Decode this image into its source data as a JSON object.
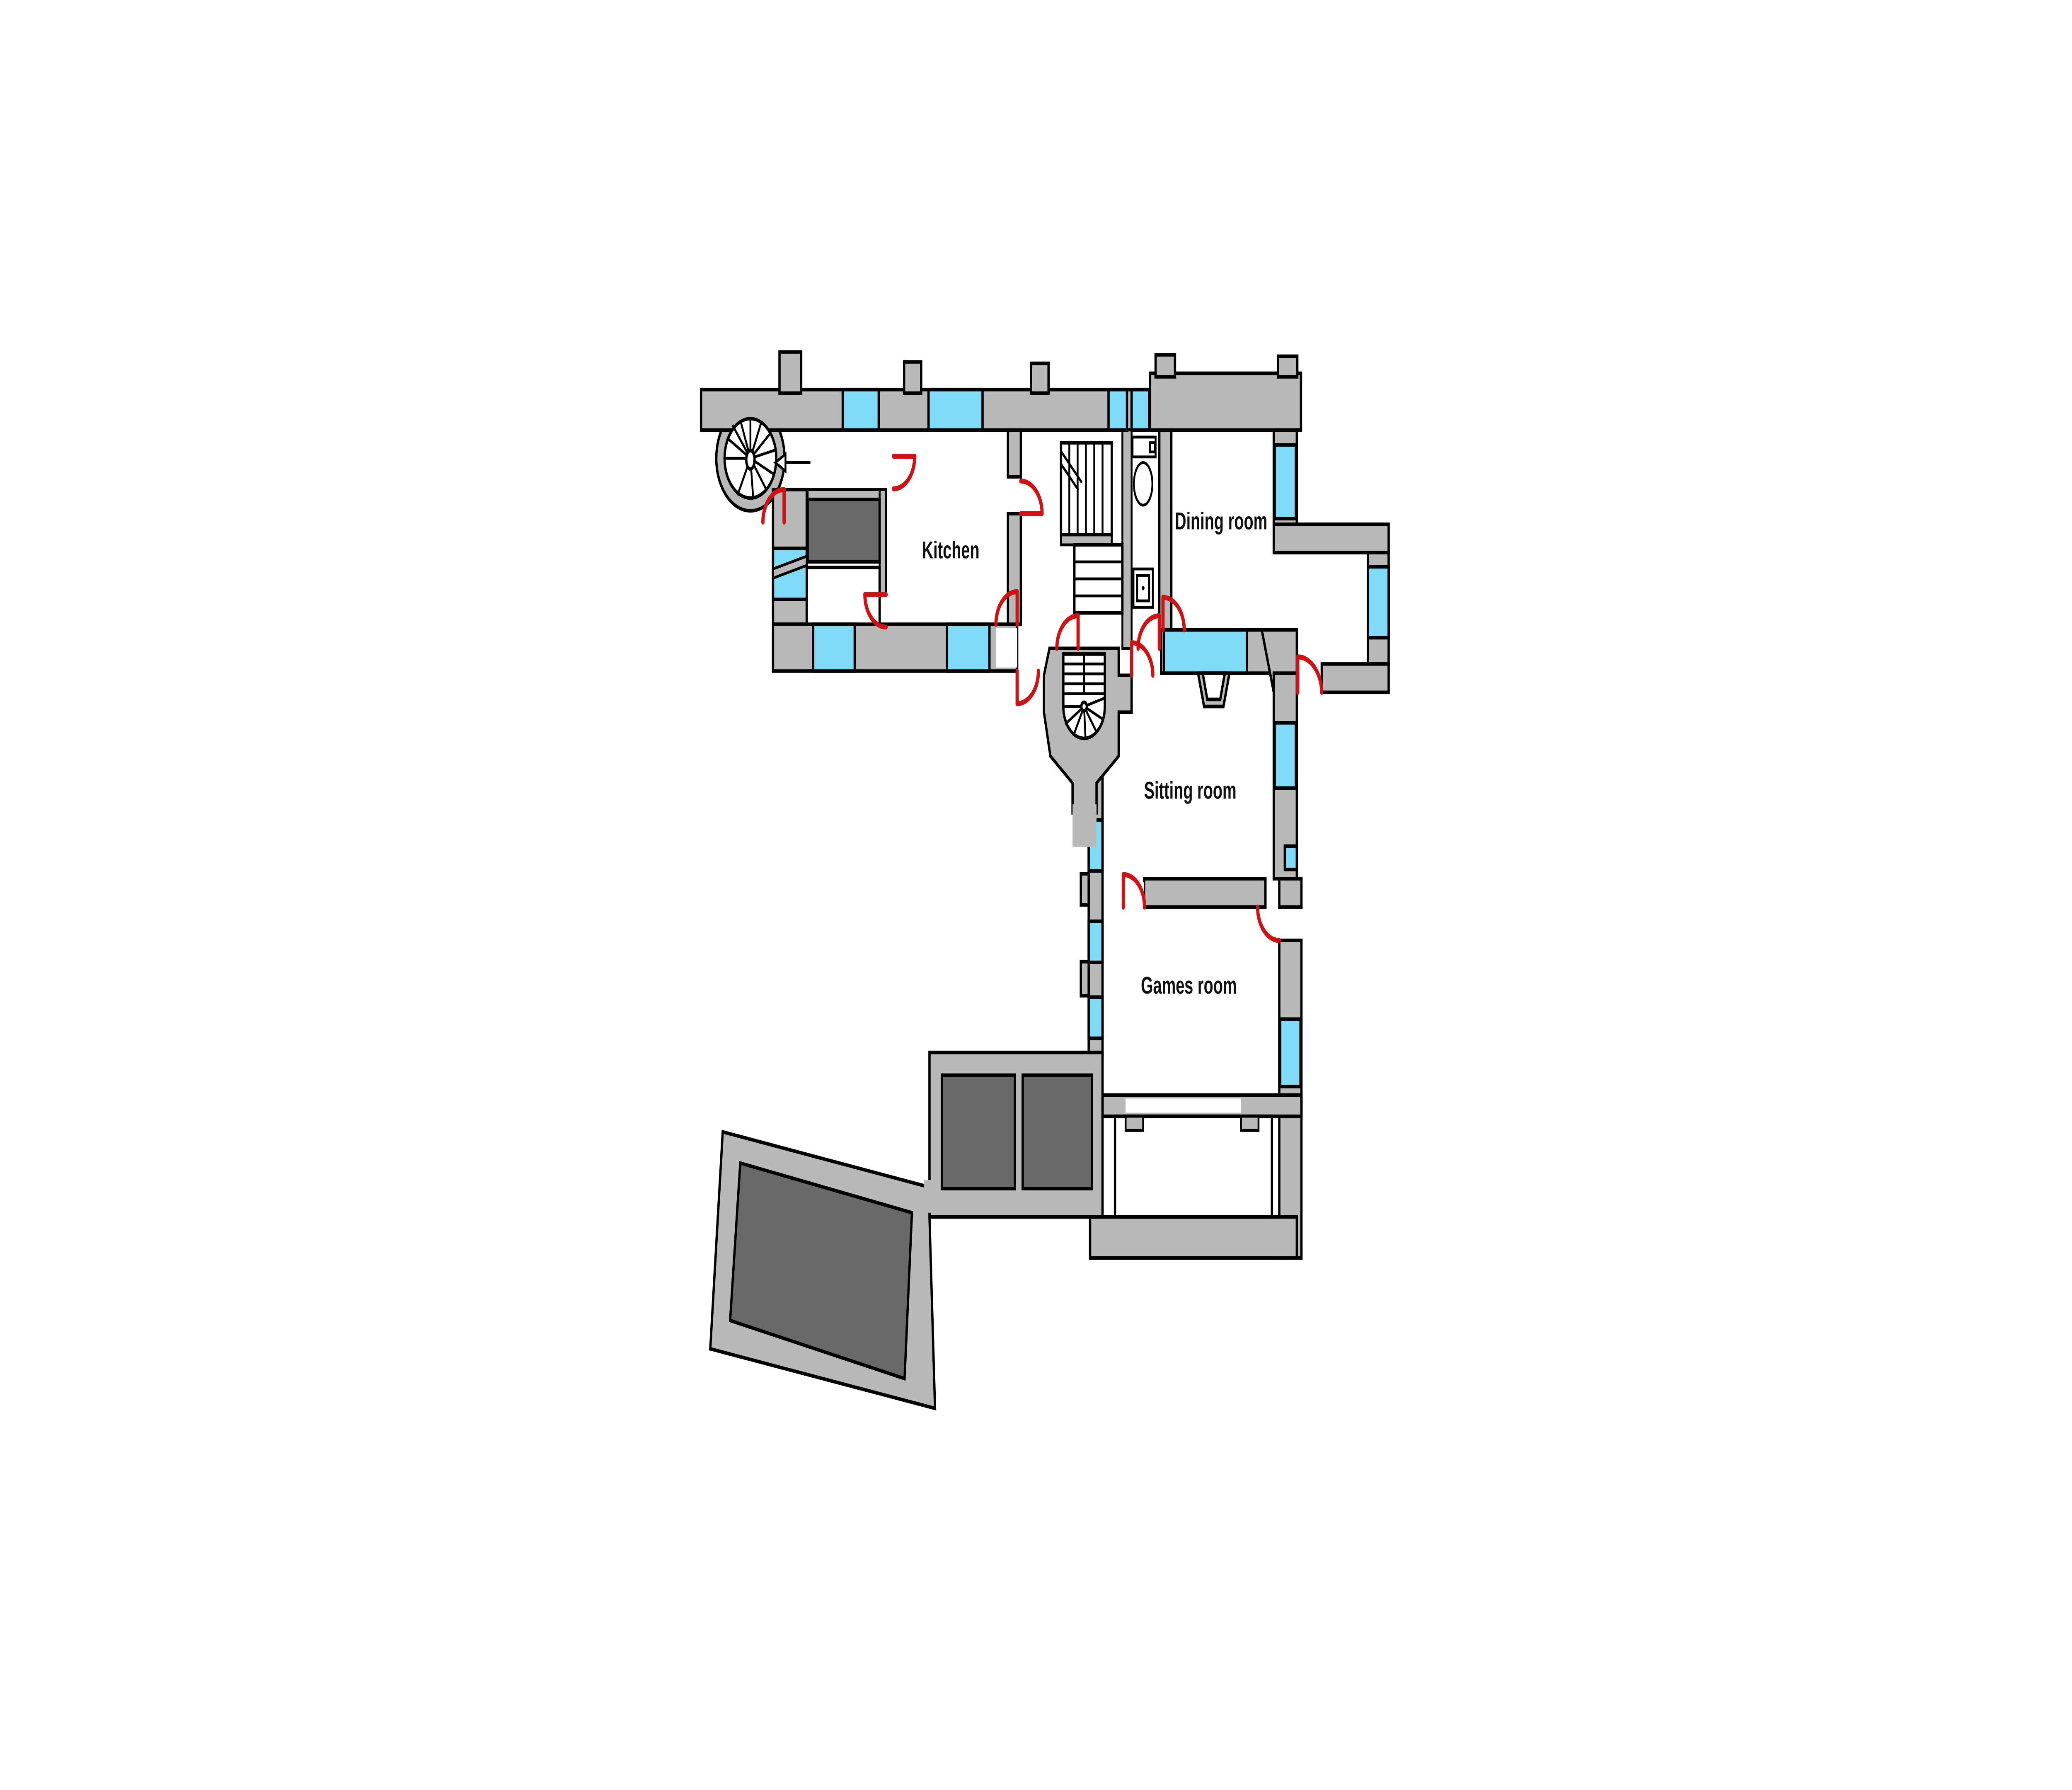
{
  "plan": {
    "type": "floor-plan",
    "rooms": [
      {
        "id": "kitchen",
        "label": "Kitchen"
      },
      {
        "id": "dining-room",
        "label": "Dining room"
      },
      {
        "id": "sitting-room",
        "label": "Sitting room"
      },
      {
        "id": "games-room",
        "label": "Games room"
      }
    ],
    "features": [
      "spiral-staircase-northwest",
      "spiral-staircase-central",
      "straight-staircase",
      "wc-toilet",
      "wc-cistern",
      "wc-sink",
      "kitchen-fireplace",
      "north-arrow",
      "terrace-platform",
      "twin-court-blocks",
      "windows",
      "door-swings"
    ],
    "colors": {
      "wall": "#b9b9b9",
      "window": "#7fdbf7",
      "door": "#d01215",
      "dark_fill": "#696969",
      "outline": "#000000",
      "background": "#ffffff"
    }
  }
}
